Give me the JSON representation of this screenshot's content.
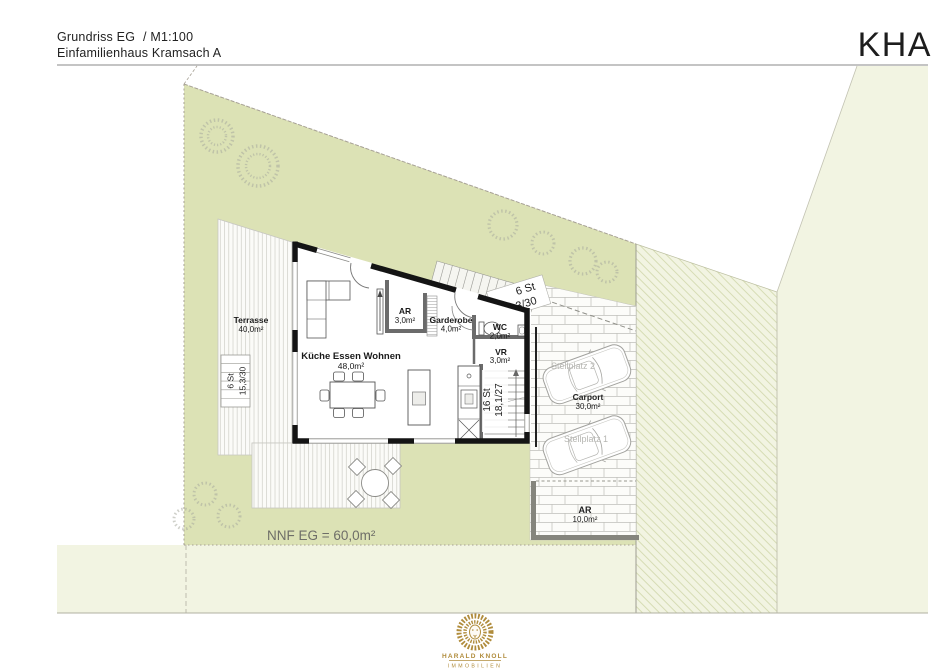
{
  "header": {
    "title": "Grundriss EG",
    "scale": "/ M1:100",
    "subtitle": "Einfamilienhaus Kramsach A",
    "brand": "KHA"
  },
  "plan": {
    "nnf": "NNF EG = 60,0m²",
    "rooms": {
      "terrasse": {
        "name": "Terrasse",
        "area": "40,0m²"
      },
      "wohnen": {
        "name": "Küche Essen Wohnen",
        "area": "48,0m²"
      },
      "ar": {
        "name": "AR",
        "area": "3,0m²"
      },
      "garderobe": {
        "name": "Garderobe",
        "area": "4,0m²"
      },
      "wc": {
        "name": "WC",
        "area": "2,0m²"
      },
      "vr": {
        "name": "VR",
        "area": "3,0m²"
      },
      "carport": {
        "name": "Carport",
        "area": "30,0m²"
      },
      "abstellraum": {
        "name": "AR",
        "area": "10,0m²"
      },
      "stellplatz1": {
        "name": "Stellplatz 1"
      },
      "stellplatz2": {
        "name": "Stellplatz 2"
      }
    },
    "stairs": {
      "terrace": {
        "count": "6 St",
        "dim": "15,3/30"
      },
      "entry": {
        "count": "6 St",
        "dim": "15,3/30"
      },
      "interior": {
        "count": "16 St",
        "dim": "18,1/27"
      }
    }
  },
  "logo": {
    "line1": "HARALD KNOLL",
    "line2": "IMMOBILIEN"
  },
  "colors": {
    "site_green": "#dce2b5",
    "neighbor_pale": "#f2f4e2",
    "logo_gold": "#b08c3c"
  }
}
